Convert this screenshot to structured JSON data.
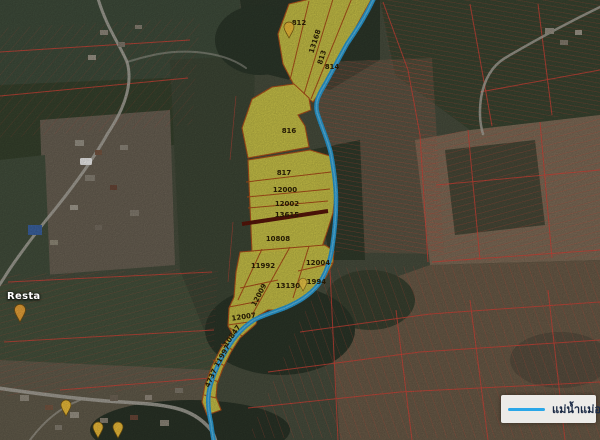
{
  "map": {
    "parcels": [
      "812",
      "13168",
      "813",
      "814",
      "816",
      "817",
      "12000",
      "12002",
      "13615",
      "10808",
      "11992",
      "12004",
      "13130",
      "11994",
      "12009",
      "12007",
      "10847",
      "11997",
      "4737"
    ],
    "legend": {
      "label": "แม่น้ำแม่ออน"
    },
    "place_labels": [
      "Resta"
    ],
    "colors": {
      "river": "#2BA3DE",
      "parcel_fill": "#DDD44C",
      "parcel_border": "#B4541C",
      "cadastral_line": "#E0473B",
      "dark_boundary": "#5C170B",
      "legend_line": "#2AA7E8",
      "legend_text": "#1B2A45"
    }
  }
}
